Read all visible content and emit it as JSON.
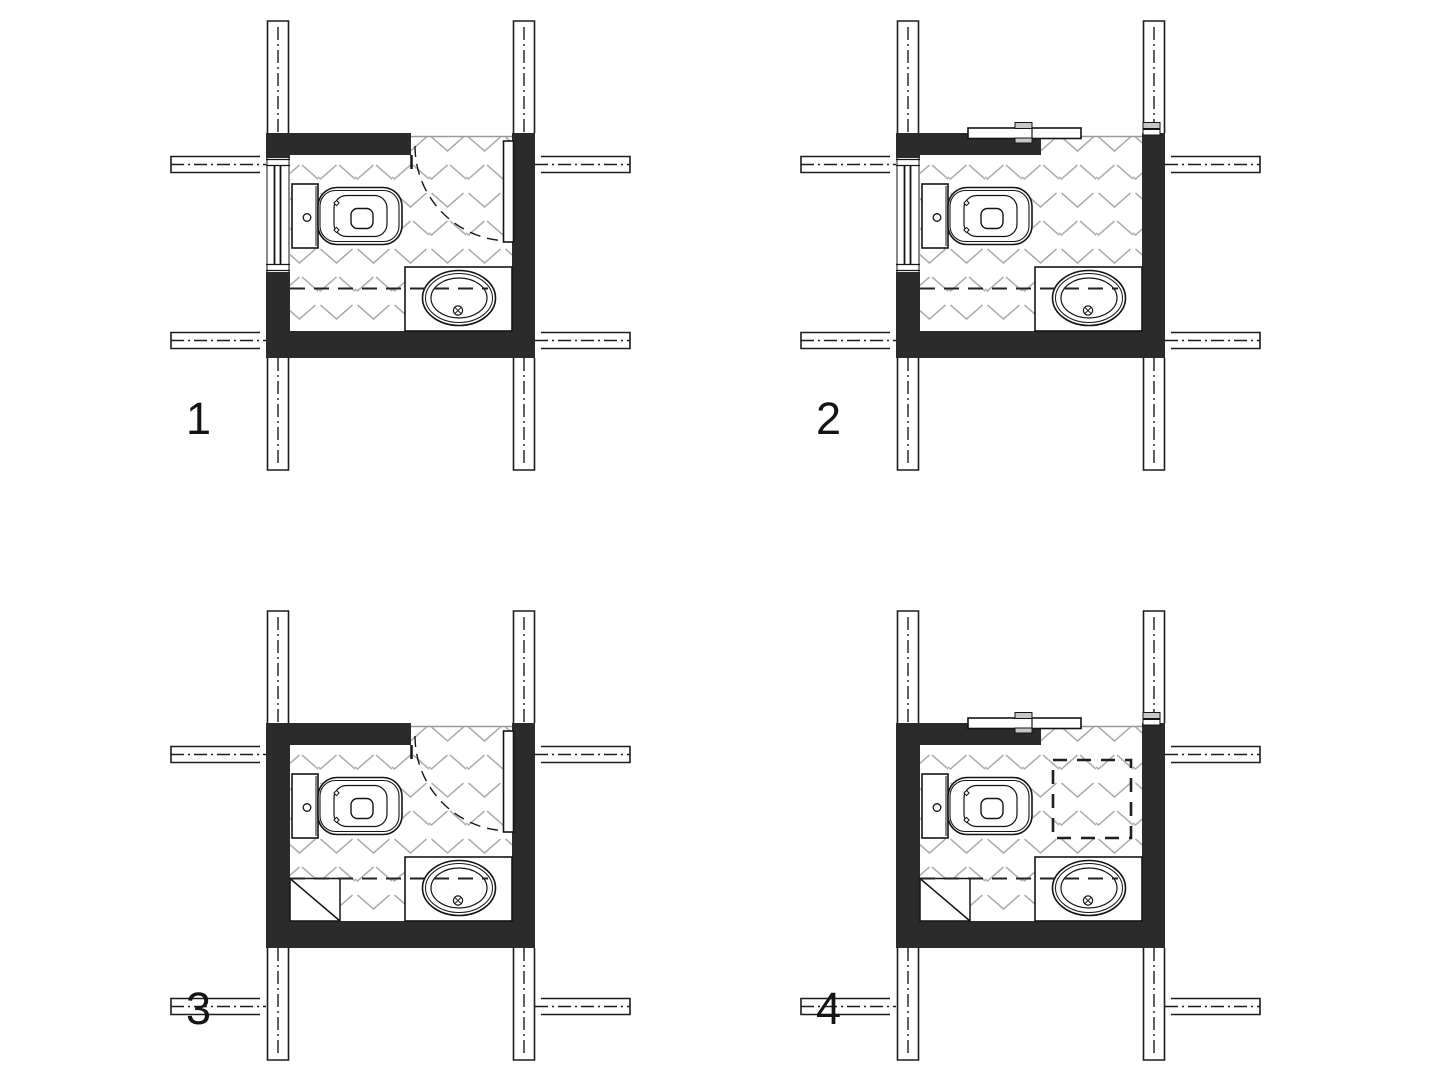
{
  "sheet": {
    "type": "architectural floor plan comparison sheet",
    "description": "Four WC layout variants shown in plan view with modular grid axes",
    "background": "#ffffff"
  },
  "colors": {
    "wall_poche": "#2b2b2b",
    "line": "#141414",
    "floor_hatch": "#b0b0b0",
    "opening_header": "#9a9a9a",
    "fitting_gray": "#c8c8c8"
  },
  "plans": [
    {
      "label": "1",
      "door": "hinged-swing",
      "window_on_left_wall": true,
      "corner_triangle": false,
      "dashed_ceiling_square": false,
      "top_left_axis_bracket": true,
      "bottom_axis_detached": false,
      "fixtures": [
        "toilet",
        "counter-basin"
      ]
    },
    {
      "label": "2",
      "door": "sliding",
      "window_on_left_wall": true,
      "corner_triangle": false,
      "dashed_ceiling_square": false,
      "top_left_axis_bracket": true,
      "bottom_axis_detached": false,
      "fixtures": [
        "toilet",
        "counter-basin"
      ]
    },
    {
      "label": "3",
      "door": "hinged-swing",
      "window_on_left_wall": false,
      "corner_triangle": true,
      "dashed_ceiling_square": false,
      "top_left_axis_bracket": true,
      "bottom_axis_detached": true,
      "fixtures": [
        "toilet",
        "counter-basin"
      ]
    },
    {
      "label": "4",
      "door": "sliding",
      "window_on_left_wall": false,
      "corner_triangle": true,
      "dashed_ceiling_square": true,
      "top_left_axis_bracket": false,
      "bottom_axis_detached": true,
      "fixtures": [
        "toilet",
        "counter-basin"
      ]
    }
  ]
}
